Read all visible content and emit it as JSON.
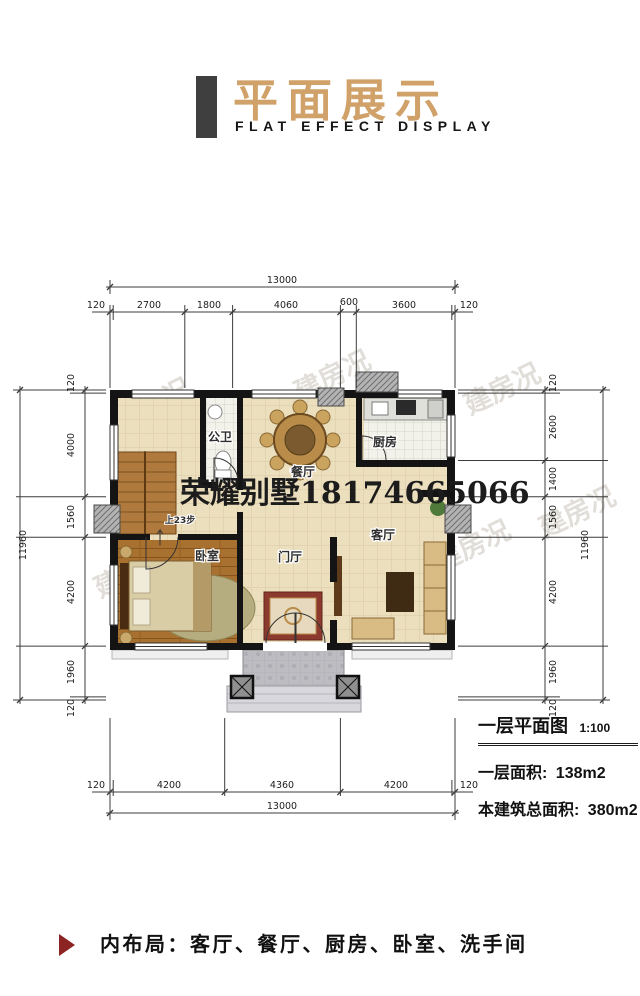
{
  "header": {
    "title": "平面展示",
    "subtitle": "FLAT EFFECT DISPLAY"
  },
  "watermark": {
    "center_text": "荣耀别墅18174665066",
    "tiled_text": "建房况"
  },
  "plan": {
    "rooms": {
      "bathroom": "公卫",
      "dining": "餐厅",
      "kitchen": "厨房",
      "living": "客厅",
      "bedroom": "卧室",
      "foyer": "门厅"
    },
    "stairs_note": "上23步",
    "dimensions": {
      "top": {
        "total": "13000",
        "segments": [
          "120",
          "2700",
          "1800",
          "4060",
          "600",
          "3600",
          "120"
        ]
      },
      "bottom": {
        "total": "13000",
        "segments": [
          "120",
          "4200",
          "4360",
          "4200",
          "120"
        ]
      },
      "left": {
        "total": "11960",
        "segments": [
          "120",
          "4000",
          "1560",
          "4200",
          "1960",
          "120"
        ]
      },
      "right": {
        "total": "11960",
        "segments": [
          "120",
          "2600",
          "1400",
          "1560",
          "4200",
          "1960",
          "120"
        ]
      }
    }
  },
  "info": {
    "plan_title": "一层平面图",
    "scale": "1:100",
    "floor_area_label": "一层面积:",
    "floor_area_value": "138m2",
    "total_area_label": "本建筑总面积:",
    "total_area_value": "380m2"
  },
  "footer": {
    "layout_text": "内布局：客厅、餐厅、厨房、卧室、洗手间"
  },
  "colors": {
    "accent_tan": "#d0a269",
    "header_bar": "#3f3f3f",
    "marker_red": "#8b2423",
    "wall_black": "#141414",
    "floor_cream": "#ecdfbe",
    "bedroom_wood": "#a9712f"
  }
}
